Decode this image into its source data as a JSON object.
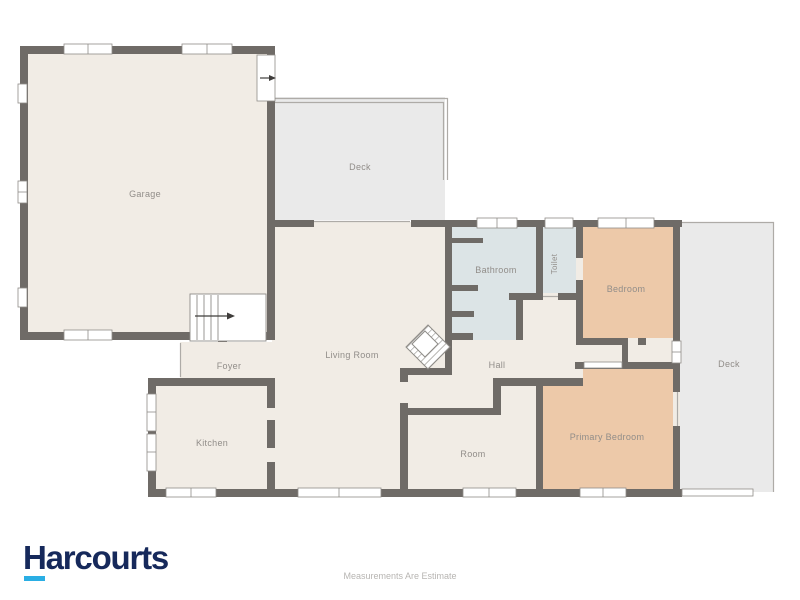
{
  "floorplan": {
    "rooms": {
      "garage": {
        "label": "Garage"
      },
      "deck_top": {
        "label": "Deck"
      },
      "bathroom": {
        "label": "Bathroom"
      },
      "toilet": {
        "label": "Toilet"
      },
      "bedroom": {
        "label": "Bedroom"
      },
      "living_room": {
        "label": "Living Room"
      },
      "hall": {
        "label": "Hall"
      },
      "foyer": {
        "label": "Foyer"
      },
      "kitchen": {
        "label": "Kitchen"
      },
      "room": {
        "label": "Room"
      },
      "primary_bedroom": {
        "label": "Primary Bedroom"
      },
      "deck_right": {
        "label": "Deck"
      }
    },
    "colors": {
      "wall": "#6f6b67",
      "floor": "#f1ece5",
      "deck": "#eaeaea",
      "wet_area": "#dce4e6",
      "bedroom_fill": "#edc9a9",
      "label_text": "#918d89",
      "window_frame": "#8f8c88",
      "thin_line": "#aeaba7",
      "arrow": "#3f3d3b"
    }
  },
  "branding": {
    "logo_text": "Harcourts",
    "logo_color": "#16295b",
    "logo_accent_color": "#2aaee4"
  },
  "footer": {
    "disclaimer": "Measurements Are Estimate"
  }
}
